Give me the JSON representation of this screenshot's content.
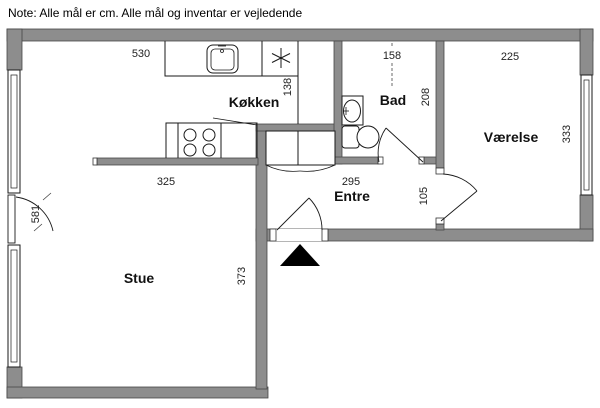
{
  "note": "Note: Alle mål er cm. Alle mål og inventar er vejledende",
  "rooms": {
    "koekken": "Køkken",
    "bad": "Bad",
    "vaerelse": "Værelse",
    "entre": "Entre",
    "stue": "Stue"
  },
  "dimensions_cm": {
    "kitchen_zone_width": "530",
    "kitchen_cabinet_depth": "138",
    "bad_width": "158",
    "bad_depth": "208",
    "vaerelse_width": "225",
    "vaerelse_depth": "333",
    "kitchen_width": "325",
    "entre_width": "295",
    "entre_depth": "105",
    "stue_wall_height": "581",
    "stue_depth": "373"
  },
  "fixtures": [
    "kitchen-sink",
    "cooktop-symbol",
    "stove-burners",
    "tall-cabinet",
    "wardrobe",
    "bathroom-sink",
    "toilet",
    "window",
    "door",
    "entrance-marker"
  ],
  "colors": {
    "wall": "#8d8d8d",
    "outline": "#000000",
    "entrance_marker": "#000000"
  }
}
